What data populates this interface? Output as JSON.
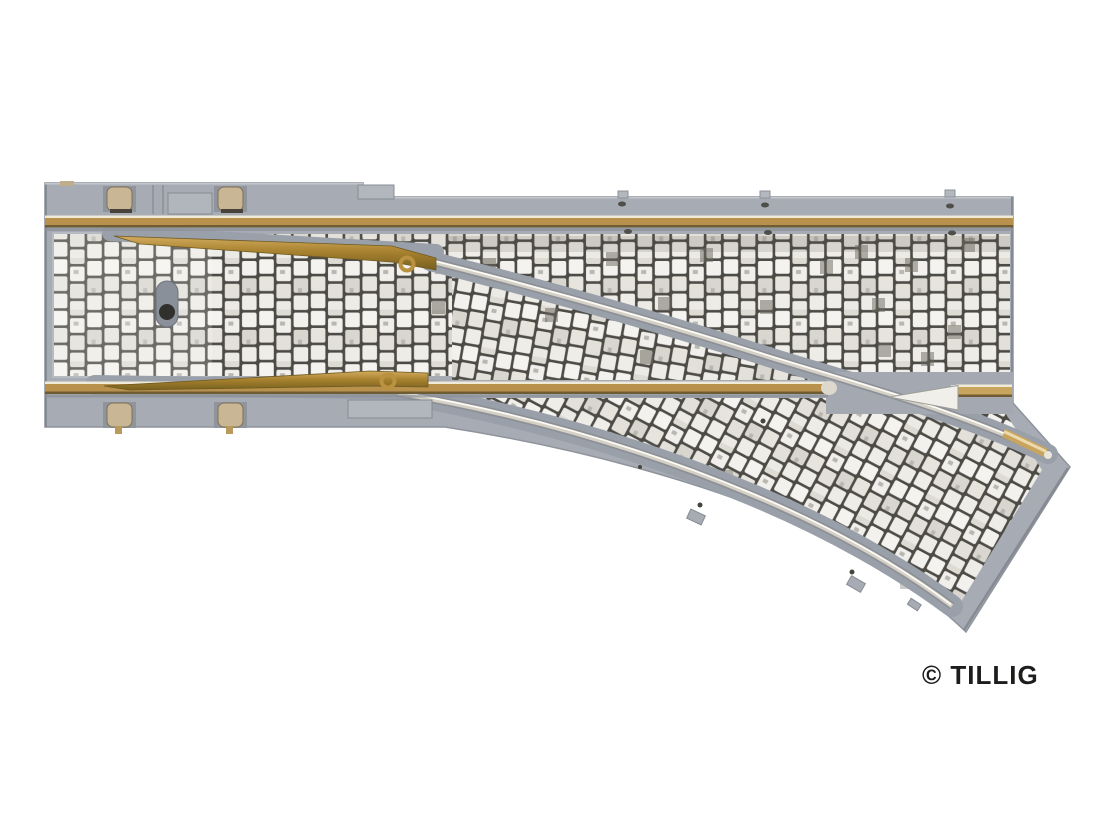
{
  "photo": {
    "subject": "Model railway street-track turnout with cobblestone paving",
    "orientation": "straight track horizontal, branch curving to lower right",
    "background": "#ffffff"
  },
  "watermark": {
    "text": "© TILLIG",
    "color": "#1d1d1b"
  },
  "colors": {
    "plastic_gray": "#a6abb4",
    "channel_gray": "#9aa0a9",
    "cobble_joint": "#4c4b45",
    "stone_light": "#f4f3ef",
    "rail_brass": "#b8914d",
    "rail_silver": "#d4d0c6",
    "blade_brass": "#a8822f",
    "contact_tan": "#c8b695",
    "frog_white": "#f1efe9"
  }
}
